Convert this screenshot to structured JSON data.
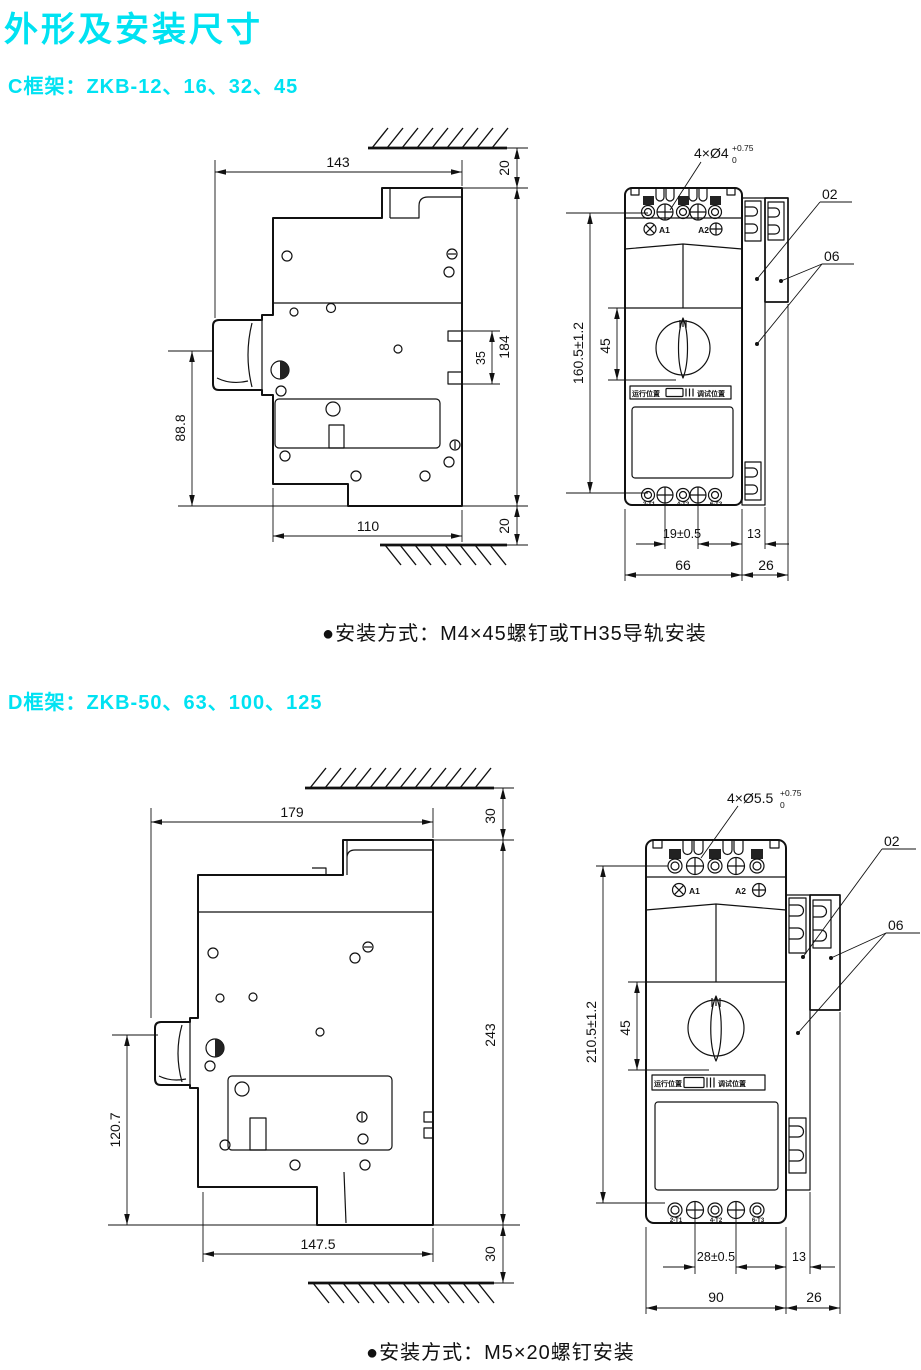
{
  "page": {
    "title": "外形及安装尺寸",
    "accent_color": "#00e2f2",
    "line_color": "#111111"
  },
  "sections": [
    {
      "heading": "C框架：ZKB-12、16、32、45",
      "note": "●安装方式：M4×45螺钉或TH35导轨安装",
      "side": {
        "w_top": "143",
        "gap_top": "20",
        "h_total": "184",
        "clip": "35",
        "h_body": "88.8",
        "w_bottom": "110",
        "gap_bottom": "20"
      },
      "front": {
        "holes": "4×Ø4",
        "tol_up": "+0.75",
        "tol_dn": "0",
        "h": "160.5±1.2",
        "knob": "45",
        "pitch": "19±0.5",
        "rail": "13",
        "w": "66",
        "w_side": "26",
        "c02": "02",
        "c06": "06",
        "a1": "A1",
        "a2": "A2",
        "run": "运行位置",
        "test": "调试位置",
        "t1": "2-T1",
        "t2": "4-T2",
        "t3": "6-T3"
      }
    },
    {
      "heading": "D框架：ZKB-50、63、100、125",
      "note": "●安装方式：M5×20螺钉安装",
      "side": {
        "w_top": "179",
        "gap_top": "30",
        "h_total": "243",
        "h_body": "120.7",
        "w_bottom": "147.5",
        "gap_bottom": "30"
      },
      "front": {
        "holes": "4×Ø5.5",
        "tol_up": "+0.75",
        "tol_dn": "0",
        "h": "210.5±1.2",
        "knob": "45",
        "pitch": "28±0.5",
        "rail": "13",
        "w": "90",
        "w_side": "26",
        "c02": "02",
        "c06": "06",
        "a1": "A1",
        "a2": "A2",
        "run": "运行位置",
        "test": "调试位置",
        "t1": "2-T1",
        "t2": "4-T2",
        "t3": "6-T3"
      }
    }
  ]
}
